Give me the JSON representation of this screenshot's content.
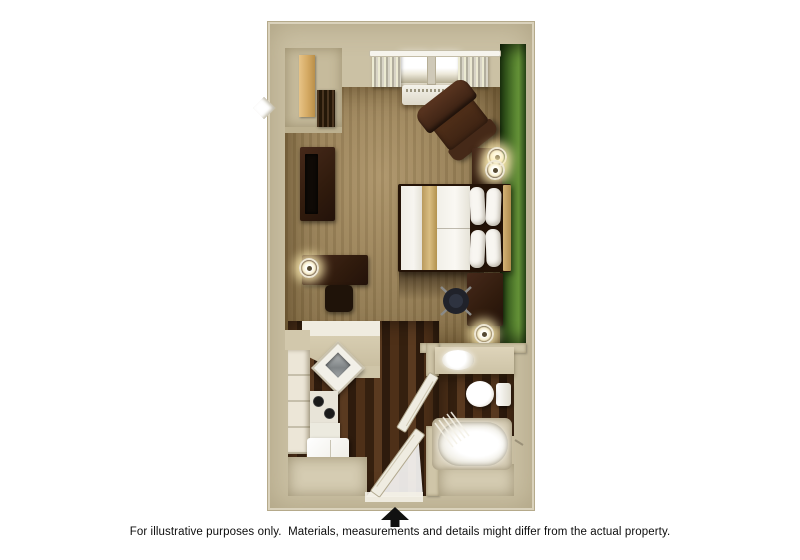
{
  "caption": {
    "text": "For illustrative purposes only.  Materials, measurements and details might differ from the actual property."
  },
  "compass": {
    "icon": "north-arrow",
    "color": "#111111"
  },
  "palette": {
    "background": "#ffffff",
    "wall_beige": "#cbc1a4",
    "accent_wall_green": "#56812f",
    "carpet_tan": "#a08350",
    "hardwood_brown": "#3c2617",
    "furniture_dark_brown": "#35200f",
    "bedding_white": "#f4f2ec",
    "bed_runner_gold": "#d3b276",
    "fixture_white": "#f6f4ee"
  },
  "floorplan": {
    "description": "studio-suite-3d-floor-plan",
    "rooms": [
      {
        "name": "sleeping-living-area",
        "floor": "carpet"
      },
      {
        "name": "kitchen",
        "floor": "hardwood"
      },
      {
        "name": "entry-hall",
        "floor": "hardwood"
      },
      {
        "name": "bathroom",
        "floor": "hardwood-and-tile"
      },
      {
        "name": "closet",
        "floor": "carpet"
      }
    ],
    "furniture": [
      "window-with-curtains",
      "ptac-air-conditioner",
      "wardrobe-closet",
      "hanging-clothes",
      "tv-console",
      "flat-screen-tv",
      "armchair-recliner",
      "nightstand",
      "table-lamp",
      "table-lamp",
      "queen-bed",
      "bed-runner",
      "pillows",
      "headboard",
      "side-desk",
      "desk-lamp",
      "stool",
      "work-desk",
      "office-chair",
      "work-desk-lamp",
      "breakfast-counter",
      "corner-kitchen-sink",
      "kitchen-cabinets",
      "two-burner-stove",
      "refrigerator",
      "entry-door",
      "bathroom-door",
      "vanity-sink",
      "toilet",
      "bathtub",
      "shower-curtain"
    ]
  }
}
